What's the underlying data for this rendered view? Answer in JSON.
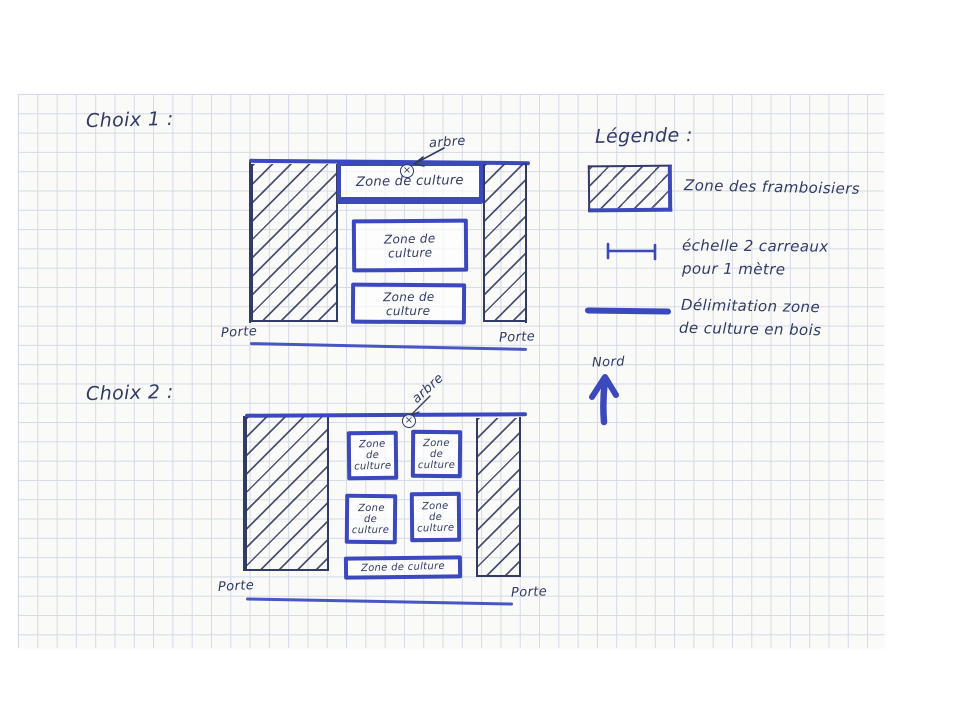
{
  "colors": {
    "ink": "#323a66",
    "blue": "#3b49bd",
    "grid": "#d5dae4",
    "paper": "#fafaf8"
  },
  "choix1": {
    "title": "Choix 1 :",
    "tree_label": "arbre",
    "tree_marker_glyph": "×",
    "zones": [
      {
        "lines": [
          "Zone de culture"
        ]
      },
      {
        "lines": [
          "Zone de",
          "culture"
        ]
      },
      {
        "lines": [
          "Zone de",
          "culture"
        ]
      }
    ],
    "porte_left": "Porte",
    "porte_right": "Porte"
  },
  "choix2": {
    "title": "Choix 2 :",
    "tree_label": "arbre",
    "tree_marker_glyph": "×",
    "zones": [
      {
        "lines": [
          "Zone",
          "de",
          "culture"
        ]
      },
      {
        "lines": [
          "Zone",
          "de",
          "culture"
        ]
      },
      {
        "lines": [
          "Zone",
          "de",
          "culture"
        ]
      },
      {
        "lines": [
          "Zone",
          "de",
          "culture"
        ]
      },
      {
        "lines": [
          "Zone de culture"
        ]
      }
    ],
    "porte_left": "Porte",
    "porte_right": "Porte"
  },
  "legend": {
    "title": "Légende :",
    "framboisiers_label": "Zone des framboisiers",
    "scale_label_line1": "échelle 2 carreaux",
    "scale_label_line2": "pour 1 mètre",
    "delimitation_label_line1": "Délimitation zone",
    "delimitation_label_line2": "de culture en bois",
    "north_label": "Nord"
  }
}
